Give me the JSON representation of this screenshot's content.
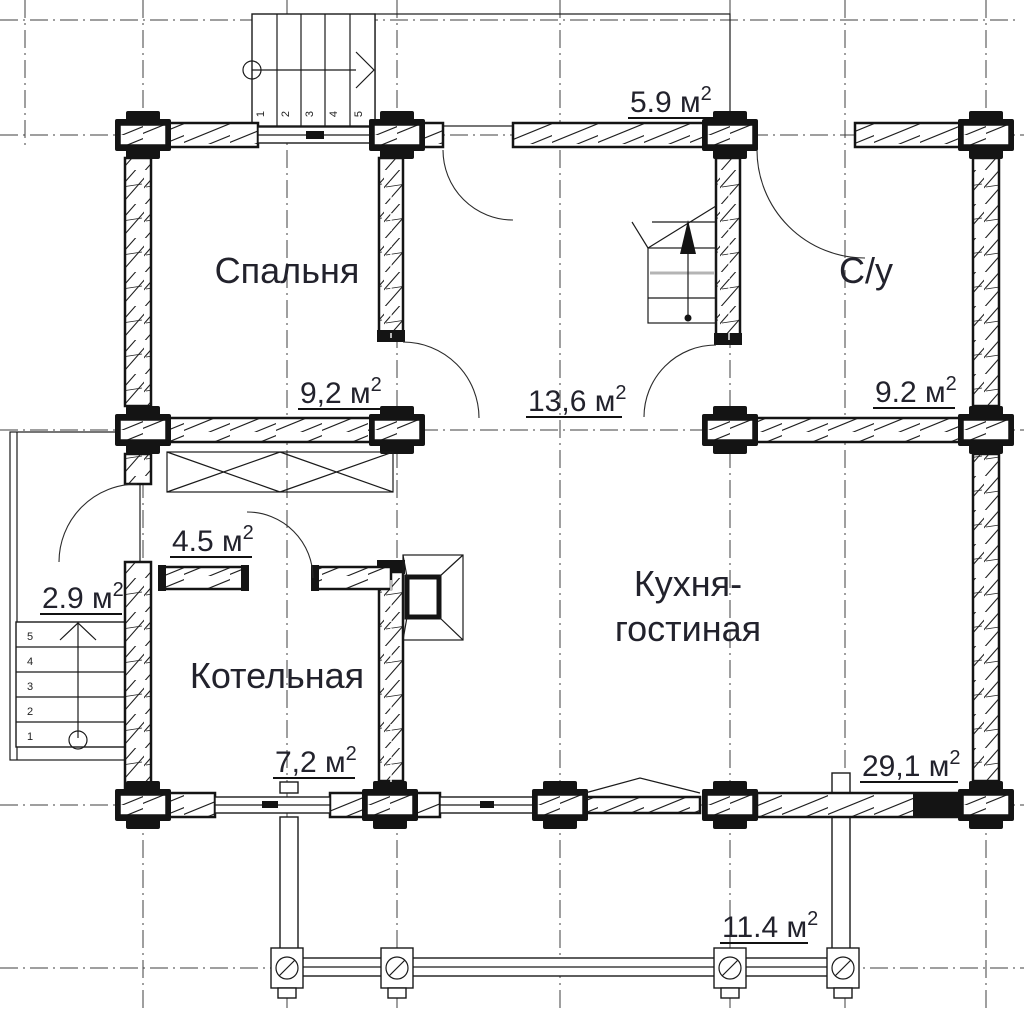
{
  "colors": {
    "line": "#1a1a1a",
    "text": "#22222c",
    "grid": "#3f3f3f",
    "tread_gray": "#b4b4b4",
    "background": "#ffffff"
  },
  "rooms": {
    "bedroom": "Спальня",
    "bathroom": "С/у",
    "boiler_room": "Котельная",
    "kitchen_living_line1": "Кухня-",
    "kitchen_living_line2": "гостиная"
  },
  "areas": {
    "entry_porch": {
      "value": "5.9 м",
      "sup": "2"
    },
    "bedroom": {
      "value": "9,2 м",
      "sup": "2"
    },
    "hall": {
      "value": "13,6 м",
      "sup": "2"
    },
    "bathroom": {
      "value": "9.2 м",
      "sup": "2"
    },
    "corridor": {
      "value": "4.5 м",
      "sup": "2"
    },
    "side_landing": {
      "value": "2.9 м",
      "sup": "2"
    },
    "boiler_room": {
      "value": "7,2 м",
      "sup": "2"
    },
    "kitchen_living": {
      "value": "29,1 м",
      "sup": "2"
    },
    "terrace": {
      "value": "11.4 м",
      "sup": "2"
    }
  },
  "stairs": {
    "top_steps": [
      "1",
      "2",
      "3",
      "4",
      "5"
    ],
    "left_steps": [
      "5",
      "4",
      "3",
      "2",
      "1"
    ]
  }
}
